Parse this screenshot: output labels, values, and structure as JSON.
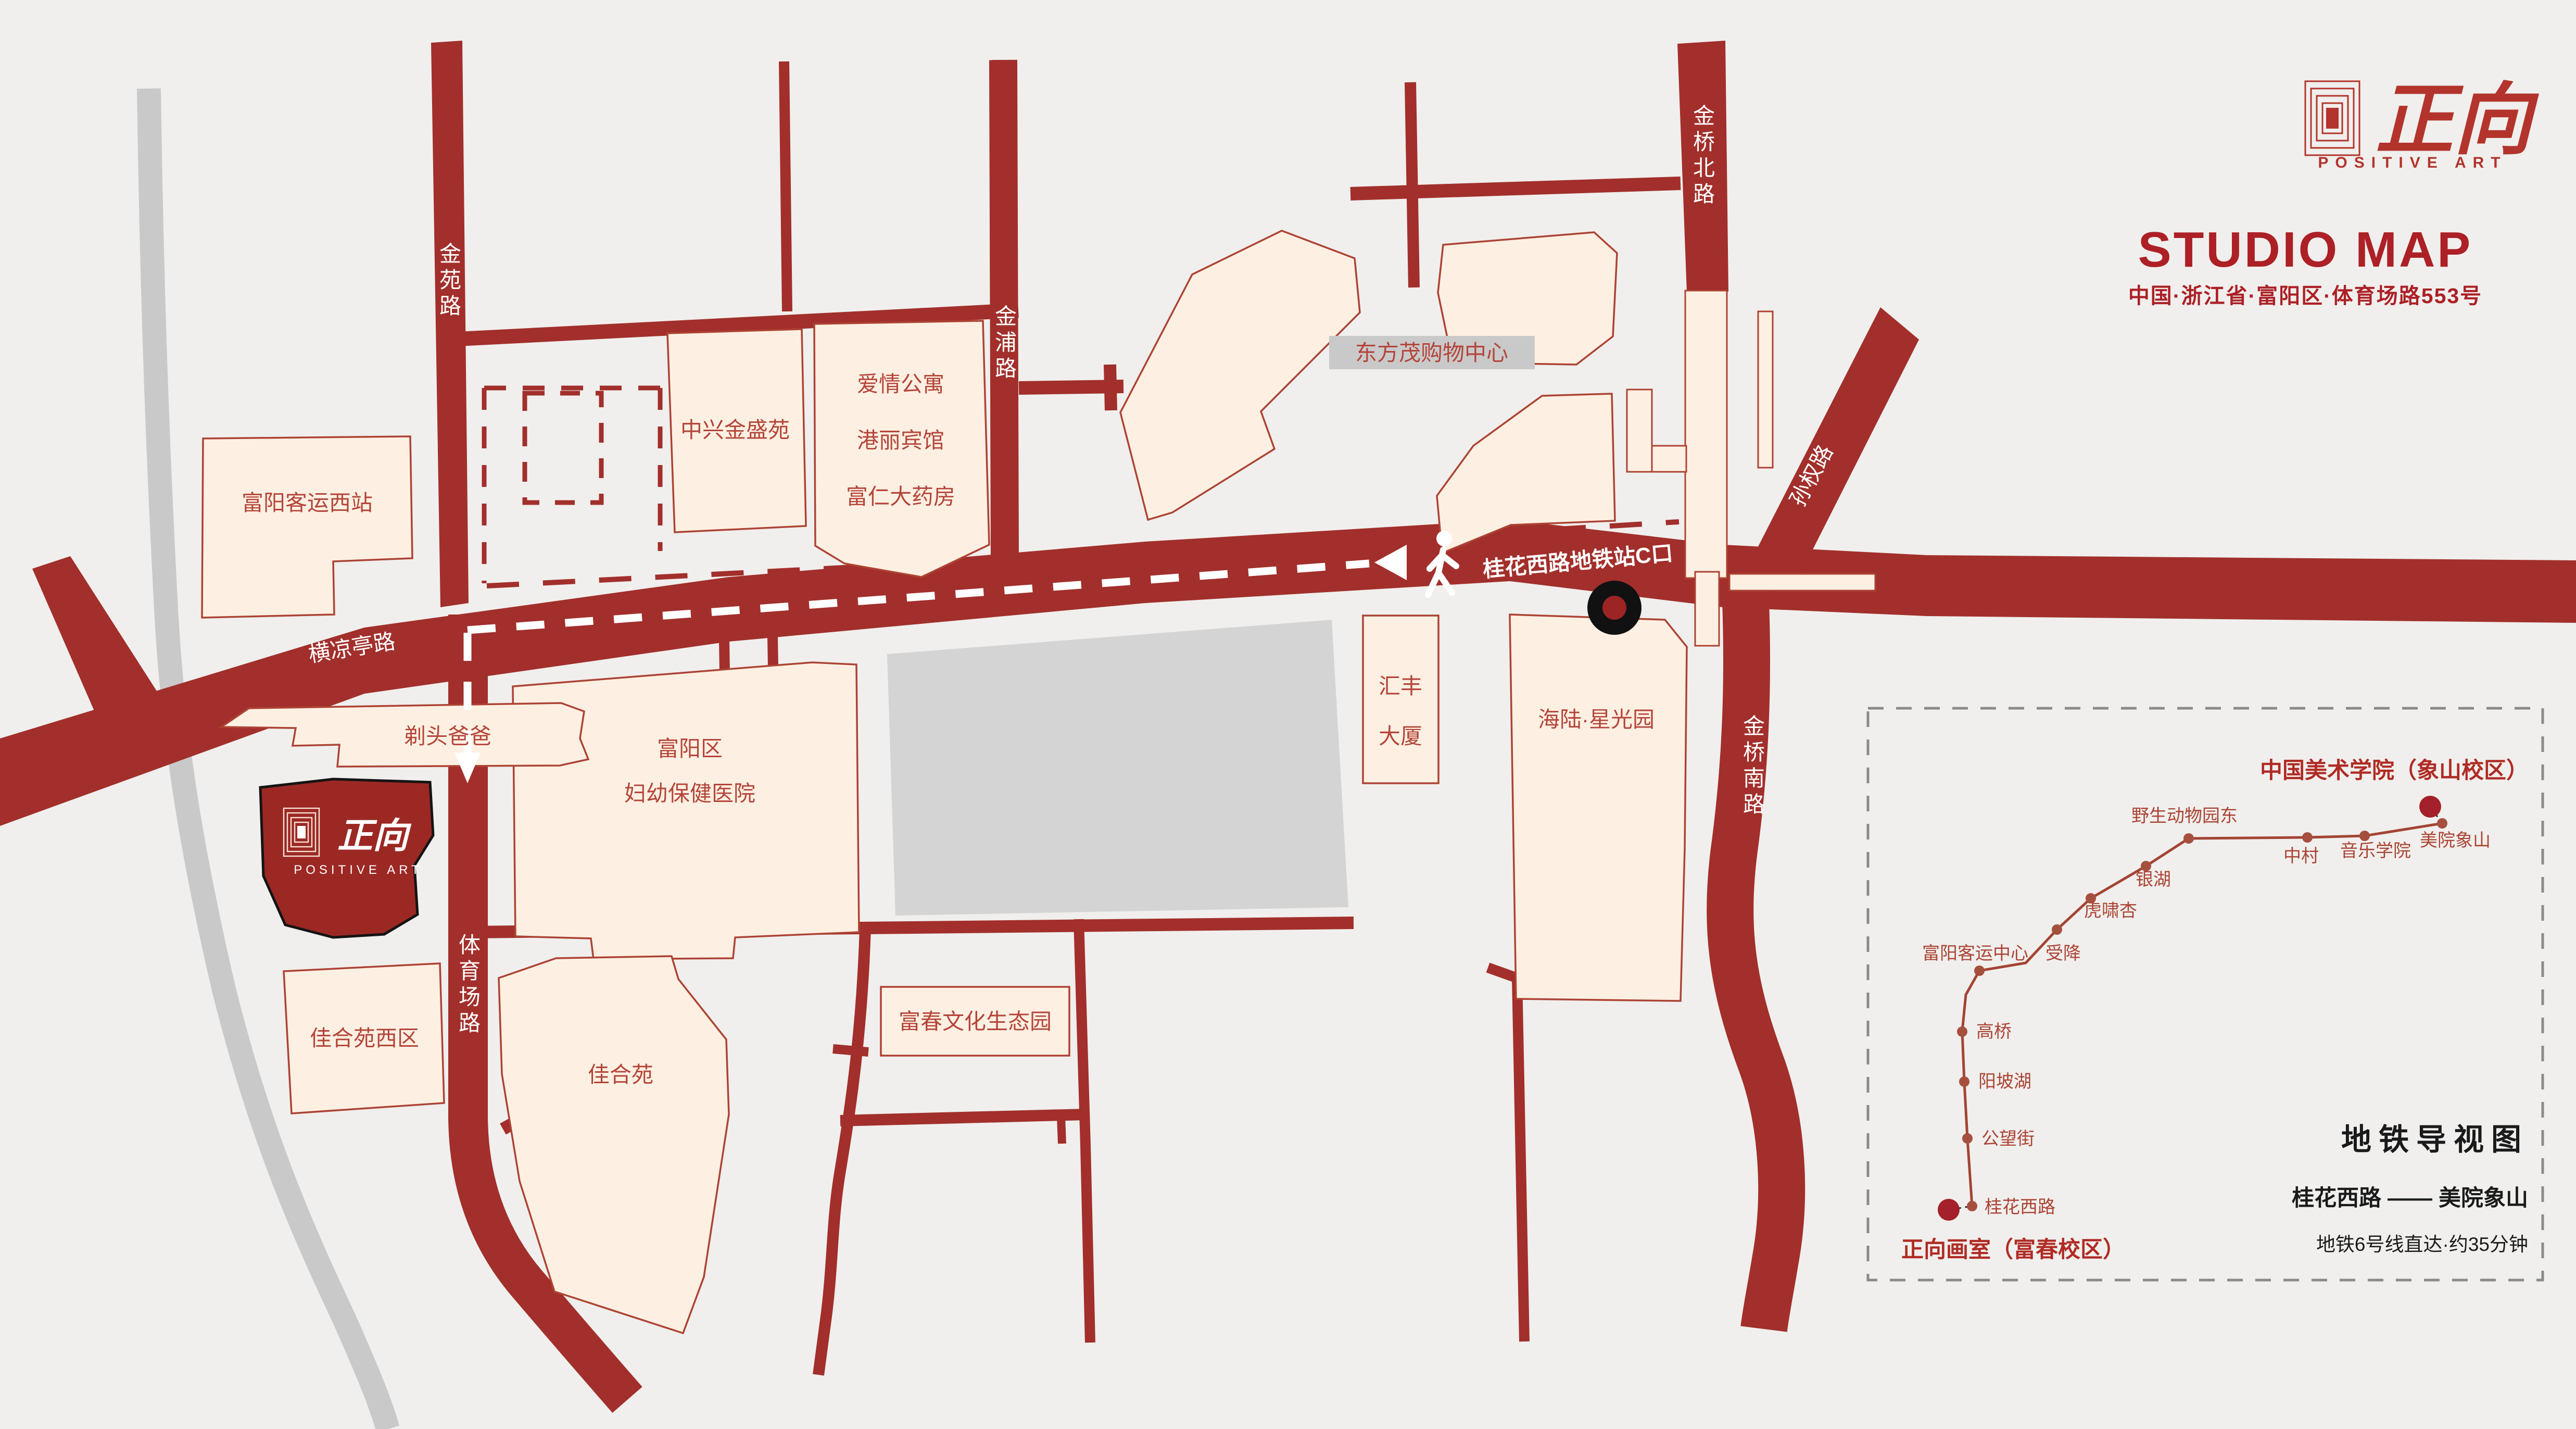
{
  "header": {
    "brand_cn": "正向",
    "brand_en": "POSITIVE ART",
    "title": "STUDIO MAP",
    "address": "中国·浙江省·富阳区·体育场路553号"
  },
  "colors": {
    "background": "#f0efed",
    "road_red": "#a22f2b",
    "building_fill": "#fdf0e2",
    "building_border": "#ad4334",
    "building_text": "#b4453a",
    "studio_fill": "#9c2824",
    "gray_road": "#c9c9c9",
    "gray_block": "#d4d4d4",
    "title_red": "#ac2026",
    "metro_line": "#a34433",
    "metro_terminal_dot": "#a4202a",
    "panel_border": "#8a8a8a",
    "marker_black": "#111111"
  },
  "map": {
    "roads": {
      "jinyuan": "金苑路",
      "jinpu": "金浦路",
      "jinqiaobei": "金桥北路",
      "sunquan": "孙权路",
      "hengliangting": "横凉亭路",
      "tiyuchang": "体育场路",
      "jinqiaonan": "金桥南路"
    },
    "route_callout": "桂花西路地铁站C口",
    "buildings": {
      "fuyang_bus_west": "富阳客运西站",
      "zhongxing": "中兴金盛苑",
      "aiqing": "爱情公寓",
      "gangli": "港丽宾馆",
      "furen": "富仁大药房",
      "dongfangmao": "东方茂购物中心",
      "huifeng_1": "汇丰",
      "huifeng_2": "大厦",
      "hailu": "海陆·星光园",
      "hospital_1": "富阳区",
      "hospital_2": "妇幼保健医院",
      "titoubaba": "剃头爸爸",
      "jiaheyuan_west": "佳合苑西区",
      "jiaheyuan": "佳合苑",
      "fuchun_eco": "富春文化生态园"
    },
    "studio": {
      "cn": "正向",
      "en": "POSITIVE ART"
    }
  },
  "metro_panel": {
    "title": "地铁导视图",
    "route": "桂花西路 —— 美院象山",
    "note": "地铁6号线直达·约35分钟",
    "origin": "正向画室（富春校区）",
    "terminus": "中国美术学院（象山校区）",
    "stations": [
      "桂花西路",
      "公望街",
      "阳坡湖",
      "高桥",
      "富阳客运中心",
      "受降",
      "虎啸杏",
      "银湖",
      "野生动物园东",
      "中村",
      "音乐学院",
      "美院象山"
    ]
  }
}
